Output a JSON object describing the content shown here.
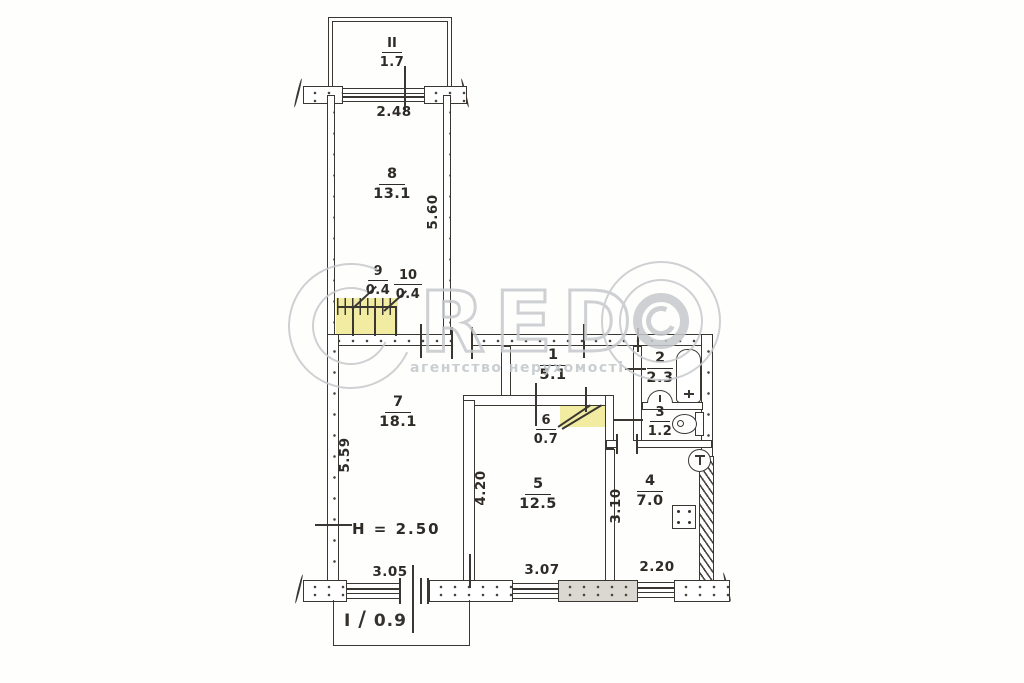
{
  "watermark": {
    "letters": "RED",
    "subtitle": "агентство нерухомості"
  },
  "rooms": {
    "balcony_top": {
      "number": "II",
      "area": "1.7"
    },
    "r8": {
      "number": "8",
      "area": "13.1"
    },
    "r9": {
      "number": "9",
      "area": "0.4"
    },
    "r10": {
      "number": "10",
      "area": "0.4"
    },
    "r1": {
      "number": "1",
      "area": "5.1"
    },
    "r2": {
      "number": "2",
      "area": "2.3"
    },
    "r3": {
      "number": "3",
      "area": "1.2"
    },
    "r7": {
      "number": "7",
      "area": "18.1"
    },
    "r6": {
      "number": "6",
      "area": "0.7"
    },
    "r5": {
      "number": "5",
      "area": "12.5"
    },
    "r4": {
      "number": "4",
      "area": "7.0"
    },
    "balcony_bottom": {
      "number": "I",
      "area": "0.9",
      "separator": "/"
    }
  },
  "dimensions": {
    "top_width": "2.48",
    "corridor_length": "5.60",
    "left_height": "5.59",
    "room5_depth": "4.20",
    "kitchen_depth": "3.10",
    "bottom_room7": "3.05",
    "bottom_room5": "3.07",
    "bottom_kitchen": "2.20",
    "ceiling_height": "H = 2.50"
  },
  "colors": {
    "ink": "#3a3733",
    "highlight": "#e9e069",
    "watermark": "#c6c9cc"
  }
}
